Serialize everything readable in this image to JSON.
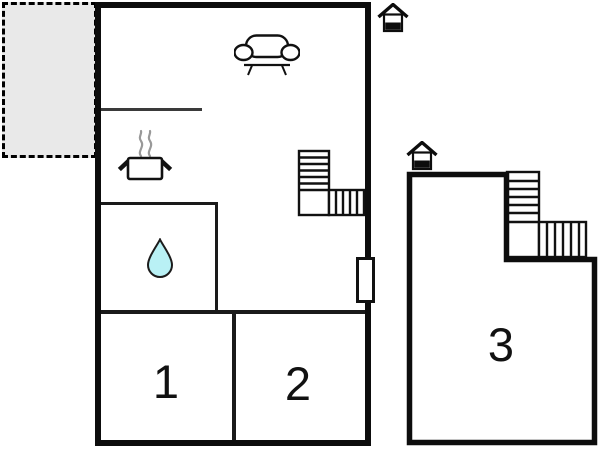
{
  "plan": {
    "type": "vacation-home-floor-plan",
    "rooms": {
      "room1": {
        "label": "1"
      },
      "room2": {
        "label": "2"
      },
      "room3": {
        "label": "3"
      }
    },
    "features": {
      "terrace": "dashed outdoor terrace",
      "living_area": "sofa-icon",
      "kitchen": "stove-icon",
      "bathroom": "water-drop-icon",
      "main_stairs": "stairs-icon",
      "annex_stairs": "stairs-icon",
      "main_entrance": "entrance-icon",
      "annex_entrance": "entrance-icon",
      "door": "door-marker"
    },
    "colors": {
      "wall": "#0d0d0d",
      "interior_wall": "#1a1a1a",
      "terrace_fill": "#e9e9e9",
      "water_drop": "#b9f1f5",
      "steam": "#999999",
      "background": "#ffffff"
    }
  }
}
